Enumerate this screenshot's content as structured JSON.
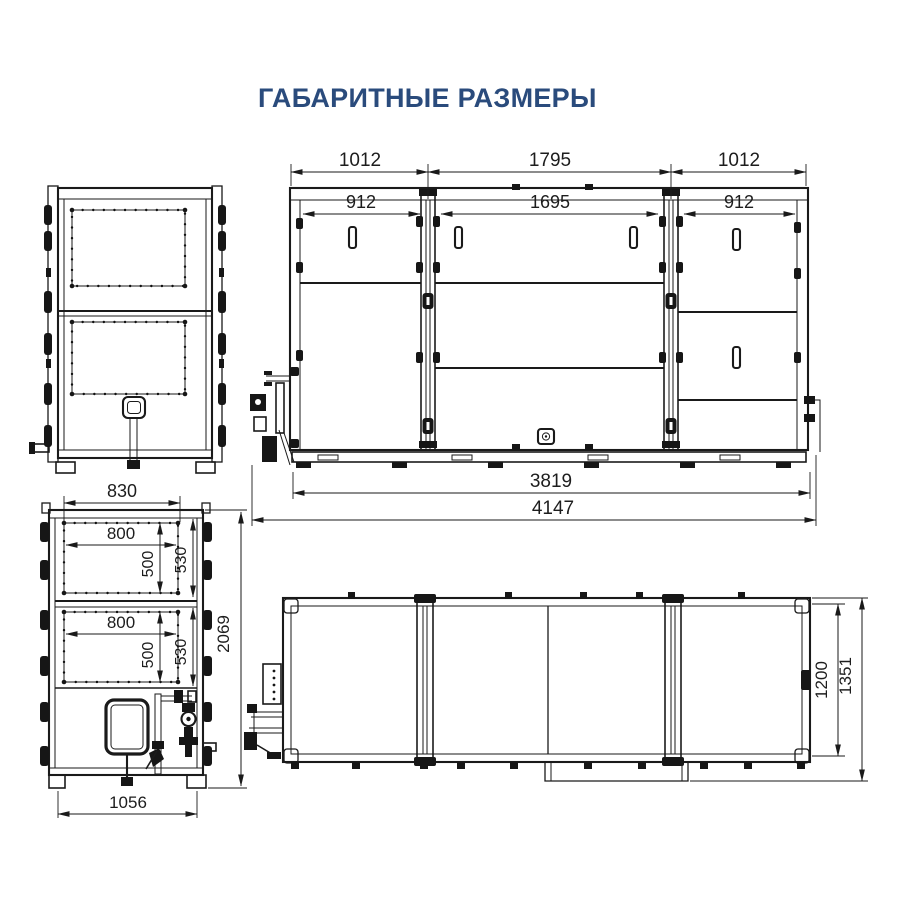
{
  "title": "ГАБАРИТНЫЕ РАЗМЕРЫ",
  "colors": {
    "title": "#2a4b7c",
    "line": "#1a1a1a",
    "background": "#ffffff"
  },
  "drawing": "Габаритный чертёж блочной установки: четыре проекции с размерными линиями",
  "dims": {
    "side_section_left": "1012",
    "side_section_middle": "1795",
    "side_section_right": "1012",
    "side_door_left": "912",
    "side_door_middle": "1695",
    "side_door_right": "912",
    "side_skid_length": "3819",
    "side_overall_length": "4147",
    "front_frame_width": "830",
    "front_window_top_width": "800",
    "front_window_top_height": "500",
    "front_door_top_height": "530",
    "front_window_bottom_width": "800",
    "front_window_bottom_height": "500",
    "front_door_bottom_height": "530",
    "front_overall_height": "2069",
    "front_base_width": "1056",
    "plan_body_width": "1200",
    "plan_overall_width": "1351"
  }
}
